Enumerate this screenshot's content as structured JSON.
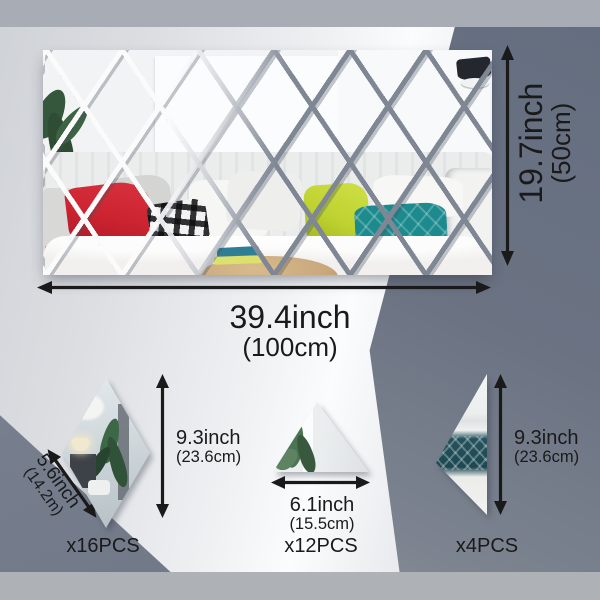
{
  "main_panel": {
    "width": {
      "value": "39.4inch",
      "metric": "(100cm)"
    },
    "height": {
      "value": "19.7inch",
      "metric": "(50cm)"
    }
  },
  "pieces": {
    "rhombus": {
      "count": "x16PCS",
      "width": {
        "value": "5.6inch",
        "metric": "(14.2m)"
      },
      "height": {
        "value": "9.3inch",
        "metric": "(23.6cm)"
      }
    },
    "triangle": {
      "count": "x12PCS",
      "width": {
        "value": "6.1inch",
        "metric": "(15.5cm)"
      }
    },
    "half_diamond": {
      "count": "x4PCS",
      "height": {
        "value": "9.3inch",
        "metric": "(23.6cm)"
      }
    }
  },
  "colors": {
    "bg-light": "#eef0f2",
    "bg-dark": "#6b7383",
    "band-top": "#a8acb4",
    "band-bottom": "#aeb1b5",
    "annotation": "#1a1a1a",
    "lattice-light": "#fbfbfc",
    "lattice-dark": "#7f8795",
    "pillow-red": "#cb2330",
    "pillow-chartreuse": "#bed230",
    "pillow-teal": "#1d8b8e"
  }
}
